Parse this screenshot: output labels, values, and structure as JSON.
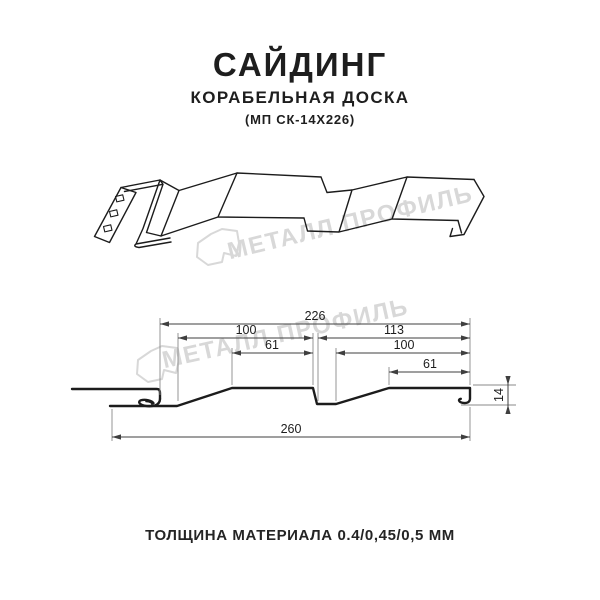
{
  "header": {
    "title": "САЙДИНГ",
    "subtitle": "КОРАБЕЛЬНАЯ ДОСКА",
    "model": "(МП СК-14Х226)"
  },
  "watermark": {
    "text": "МЕТАЛЛ ПРОФИЛЬ",
    "color": "#d8d8d8"
  },
  "cross_section": {
    "dims": {
      "working_width": "226",
      "module_left": "100",
      "board_left": "61",
      "module_right": "113",
      "board_right_module": "100",
      "board_right": "61",
      "height": "14",
      "total_width": "260"
    }
  },
  "footer": {
    "thickness_note": "ТОЛЩИНА МАТЕРИАЛА 0.4/0,45/0,5 ММ"
  },
  "colors": {
    "ink": "#1c1c1c",
    "dimension": "#3f3f3f",
    "watermark": "#d8d8d8",
    "background": "#ffffff"
  }
}
